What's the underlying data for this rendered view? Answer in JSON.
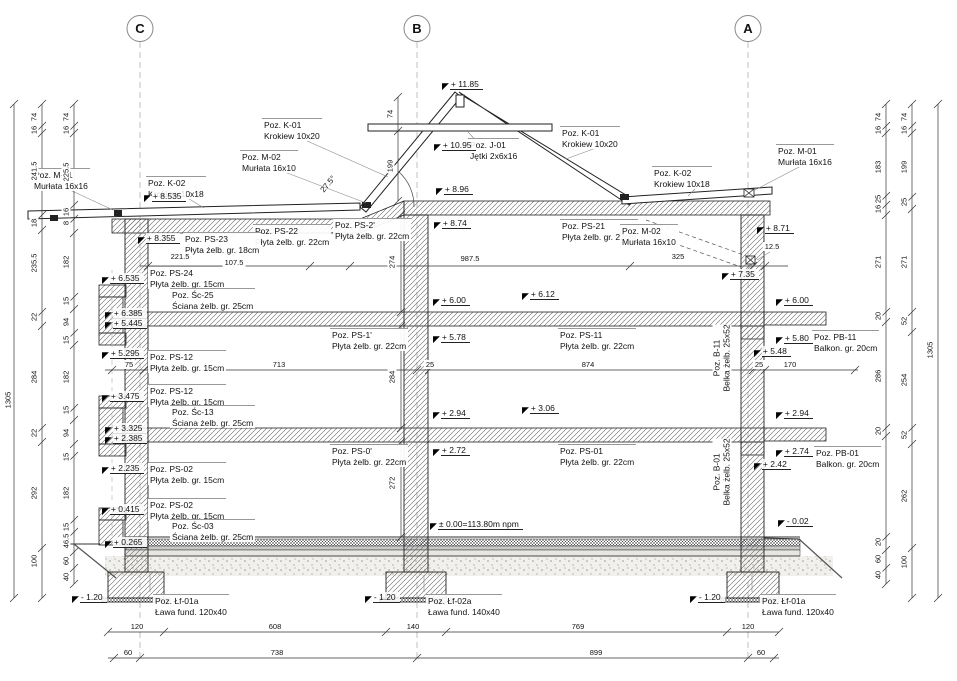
{
  "drawing": {
    "colors": {
      "line": "#222222",
      "dim_line": "#333333",
      "axis_dash": "#aaaaaa",
      "hatch": "#666666"
    },
    "axis_markers": [
      {
        "label": "C",
        "x": 140
      },
      {
        "label": "B",
        "x": 417
      },
      {
        "label": "A",
        "x": 748
      }
    ],
    "position_labels": [
      {
        "t": [
          "Poz. K-01",
          "Krokiew 10x20"
        ],
        "x": 262,
        "y": 118
      },
      {
        "t": [
          "Poz. M-02",
          "Murłata 16x10"
        ],
        "x": 240,
        "y": 150
      },
      {
        "t": [
          "Poz. J-01",
          "Jętki 2x6x16"
        ],
        "x": 468,
        "y": 138
      },
      {
        "t": [
          "Poz. K-01",
          "Krokiew 10x20"
        ],
        "x": 560,
        "y": 126
      },
      {
        "t": [
          "Poz. K-02",
          "Krokiew 10x18"
        ],
        "x": 652,
        "y": 166
      },
      {
        "t": [
          "Poz. M-01",
          "Murłata 16x16"
        ],
        "x": 776,
        "y": 144
      },
      {
        "t": [
          "Poz. M-01",
          "Murłata 16x16"
        ],
        "x": 32,
        "y": 168
      },
      {
        "t": [
          "Poz. K-02",
          "Krokiew 10x18"
        ],
        "x": 146,
        "y": 176
      },
      {
        "t": [
          "Poz. PS-22",
          "Płyta żelb. gr. 22cm"
        ],
        "x": 253,
        "y": 224
      },
      {
        "t": [
          "Poz. PS-2'",
          "Płyta żelb. gr. 22cm"
        ],
        "x": 333,
        "y": 218
      },
      {
        "t": [
          "Poz. PS-21",
          "Płyta żelb. gr. 22cm"
        ],
        "x": 560,
        "y": 219
      },
      {
        "t": [
          "Poz. M-02",
          "Murłata 16x10"
        ],
        "x": 620,
        "y": 224
      },
      {
        "t": [
          "Poz. PS-23",
          "Płyta żelb. gr. 18cm"
        ],
        "x": 183,
        "y": 232
      },
      {
        "t": [
          "Poz. PS-24",
          "Płyta żelb. gr. 15cm"
        ],
        "x": 148,
        "y": 266
      },
      {
        "t": [
          "Poz. Śc-25",
          "Ściana żelb. gr. 25cm"
        ],
        "x": 170,
        "y": 288
      },
      {
        "t": [
          "Poz. PS-1'",
          "Płyta żelb. gr. 22cm"
        ],
        "x": 330,
        "y": 328
      },
      {
        "t": [
          "Poz. PS-11",
          "Płyta żelb. gr. 22cm"
        ],
        "x": 558,
        "y": 328
      },
      {
        "t": [
          "Poz. PB-11",
          "Balkon. gr. 20cm"
        ],
        "x": 812,
        "y": 330
      },
      {
        "t": [
          "Poz. PS-12",
          "Płyta żelb. gr. 15cm"
        ],
        "x": 148,
        "y": 350
      },
      {
        "t": [
          "Poz. PS-12",
          "Płyta żelb. gr. 15cm"
        ],
        "x": 148,
        "y": 384
      },
      {
        "t": [
          "Poz. Śc-13",
          "Ściana żelb. gr. 25cm"
        ],
        "x": 170,
        "y": 405
      },
      {
        "t": [
          "Poz. PS-0'",
          "Płyta żelb. gr. 22cm"
        ],
        "x": 330,
        "y": 444
      },
      {
        "t": [
          "Poz. PS-01",
          "Płyta żelb. gr. 22cm"
        ],
        "x": 558,
        "y": 444
      },
      {
        "t": [
          "Poz. PB-01",
          "Balkon. gr. 20cm"
        ],
        "x": 814,
        "y": 446
      },
      {
        "t": [
          "Poz. PS-02",
          "Płyta żelb. gr. 15cm"
        ],
        "x": 148,
        "y": 462
      },
      {
        "t": [
          "Poz. PS-02",
          "Płyta żelb. gr. 15cm"
        ],
        "x": 148,
        "y": 498
      },
      {
        "t": [
          "Poz. Śc-03",
          "Ściana żelb. gr. 25cm"
        ],
        "x": 170,
        "y": 519
      },
      {
        "t": [
          "Poz. Łf-01a",
          "Ława fund. 120x40"
        ],
        "x": 153,
        "y": 594
      },
      {
        "t": [
          "Poz. Łf-02a",
          "Ława fund. 140x40"
        ],
        "x": 426,
        "y": 594
      },
      {
        "t": [
          "Poz. Łf-01a",
          "Ława fund. 120x40"
        ],
        "x": 760,
        "y": 594
      }
    ],
    "beam_labels": [
      {
        "t": [
          "Poz. B-11",
          "Belka żelb. 25x52"
        ],
        "x": 722,
        "y": 358
      },
      {
        "t": [
          "Poz. B-01",
          "Belka żelb. 25x52"
        ],
        "x": 722,
        "y": 472
      }
    ],
    "elevation_marks": [
      {
        "v": "+ 11.85",
        "x": 442,
        "y": 79
      },
      {
        "v": "+ 10.95",
        "x": 434,
        "y": 140
      },
      {
        "v": "+ 8.96",
        "x": 436,
        "y": 184
      },
      {
        "v": "+ 8.74",
        "x": 434,
        "y": 218
      },
      {
        "v": "+ 8.535",
        "x": 144,
        "y": 191
      },
      {
        "v": "+ 8.355",
        "x": 138,
        "y": 233
      },
      {
        "v": "+ 8.71",
        "x": 757,
        "y": 223
      },
      {
        "v": "+ 7.35",
        "x": 722,
        "y": 269
      },
      {
        "v": "+ 6.535",
        "x": 102,
        "y": 273
      },
      {
        "v": "+ 6.385",
        "x": 105,
        "y": 308
      },
      {
        "v": "+ 5.445",
        "x": 105,
        "y": 318
      },
      {
        "v": "+ 5.295",
        "x": 102,
        "y": 348
      },
      {
        "v": "+ 6.00",
        "x": 433,
        "y": 295
      },
      {
        "v": "+ 6.12",
        "x": 522,
        "y": 289
      },
      {
        "v": "+ 5.78",
        "x": 433,
        "y": 332
      },
      {
        "v": "+ 6.00",
        "x": 776,
        "y": 295
      },
      {
        "v": "+ 5.80",
        "x": 776,
        "y": 333
      },
      {
        "v": "+ 5.48",
        "x": 754,
        "y": 346
      },
      {
        "v": "+ 3.475",
        "x": 102,
        "y": 391
      },
      {
        "v": "+ 3.325",
        "x": 105,
        "y": 423
      },
      {
        "v": "+ 2.385",
        "x": 105,
        "y": 433
      },
      {
        "v": "+ 2.235",
        "x": 102,
        "y": 463
      },
      {
        "v": "+ 2.94",
        "x": 433,
        "y": 408
      },
      {
        "v": "+ 3.06",
        "x": 522,
        "y": 403
      },
      {
        "v": "+ 2.72",
        "x": 433,
        "y": 445
      },
      {
        "v": "+ 2.94",
        "x": 776,
        "y": 408
      },
      {
        "v": "+ 2.74",
        "x": 776,
        "y": 446
      },
      {
        "v": "+ 2.42",
        "x": 754,
        "y": 459
      },
      {
        "v": "+ 0.415",
        "x": 102,
        "y": 504
      },
      {
        "v": "+ 0.265",
        "x": 105,
        "y": 537
      },
      {
        "v": "± 0.00=113.80m npm",
        "x": 430,
        "y": 519
      },
      {
        "v": "- 0.02",
        "x": 778,
        "y": 516
      },
      {
        "v": "- 1.20",
        "x": 72,
        "y": 592
      },
      {
        "v": "- 1.20",
        "x": 365,
        "y": 592
      },
      {
        "v": "- 1.20",
        "x": 690,
        "y": 592
      }
    ],
    "dim_vertical": [
      {
        "v": "74",
        "x": 66,
        "y": 117
      },
      {
        "v": "16",
        "x": 66,
        "y": 130
      },
      {
        "v": "225.5",
        "x": 66,
        "y": 172
      },
      {
        "v": "16",
        "x": 66,
        "y": 212
      },
      {
        "v": "8",
        "x": 66,
        "y": 223
      },
      {
        "v": "182",
        "x": 66,
        "y": 262
      },
      {
        "v": "15",
        "x": 66,
        "y": 301
      },
      {
        "v": "94",
        "x": 66,
        "y": 322
      },
      {
        "v": "15",
        "x": 66,
        "y": 340
      },
      {
        "v": "182",
        "x": 66,
        "y": 377
      },
      {
        "v": "15",
        "x": 66,
        "y": 410
      },
      {
        "v": "94",
        "x": 66,
        "y": 433
      },
      {
        "v": "15",
        "x": 66,
        "y": 457
      },
      {
        "v": "182",
        "x": 66,
        "y": 493
      },
      {
        "v": "15",
        "x": 66,
        "y": 527
      },
      {
        "v": "46.5",
        "x": 66,
        "y": 541
      },
      {
        "v": "60",
        "x": 66,
        "y": 561
      },
      {
        "v": "40",
        "x": 66,
        "y": 577
      },
      {
        "v": "74",
        "x": 34,
        "y": 117
      },
      {
        "v": "16",
        "x": 34,
        "y": 130
      },
      {
        "v": "241.5",
        "x": 34,
        "y": 171
      },
      {
        "v": "18",
        "x": 34,
        "y": 223
      },
      {
        "v": "235.5",
        "x": 34,
        "y": 263
      },
      {
        "v": "22",
        "x": 34,
        "y": 317
      },
      {
        "v": "284",
        "x": 34,
        "y": 377
      },
      {
        "v": "22",
        "x": 34,
        "y": 433
      },
      {
        "v": "292",
        "x": 34,
        "y": 493
      },
      {
        "v": "100",
        "x": 34,
        "y": 561
      },
      {
        "v": "1305",
        "x": 8,
        "y": 400
      },
      {
        "v": "74",
        "x": 390,
        "y": 114
      },
      {
        "v": "199",
        "x": 390,
        "y": 166
      },
      {
        "v": "274",
        "x": 392,
        "y": 262
      },
      {
        "v": "284",
        "x": 392,
        "y": 377
      },
      {
        "v": "272",
        "x": 392,
        "y": 483
      },
      {
        "v": "74",
        "x": 878,
        "y": 117
      },
      {
        "v": "16",
        "x": 878,
        "y": 130
      },
      {
        "v": "183",
        "x": 878,
        "y": 167
      },
      {
        "v": "25",
        "x": 878,
        "y": 199
      },
      {
        "v": "16",
        "x": 878,
        "y": 209
      },
      {
        "v": "271",
        "x": 878,
        "y": 262
      },
      {
        "v": "20",
        "x": 878,
        "y": 316
      },
      {
        "v": "286",
        "x": 878,
        "y": 376
      },
      {
        "v": "20",
        "x": 878,
        "y": 431
      },
      {
        "v": "20",
        "x": 878,
        "y": 542
      },
      {
        "v": "60",
        "x": 878,
        "y": 559
      },
      {
        "v": "40",
        "x": 878,
        "y": 575
      },
      {
        "v": "74",
        "x": 904,
        "y": 117
      },
      {
        "v": "16",
        "x": 904,
        "y": 130
      },
      {
        "v": "199",
        "x": 904,
        "y": 167
      },
      {
        "v": "25",
        "x": 904,
        "y": 202
      },
      {
        "v": "271",
        "x": 904,
        "y": 262
      },
      {
        "v": "52",
        "x": 904,
        "y": 321
      },
      {
        "v": "254",
        "x": 904,
        "y": 380
      },
      {
        "v": "52",
        "x": 904,
        "y": 435
      },
      {
        "v": "262",
        "x": 904,
        "y": 496
      },
      {
        "v": "100",
        "x": 904,
        "y": 562
      },
      {
        "v": "1305",
        "x": 930,
        "y": 350
      }
    ],
    "dim_horizontal": [
      {
        "v": "221.5",
        "x": 180,
        "y": 252
      },
      {
        "v": "107.5",
        "x": 234,
        "y": 258
      },
      {
        "v": "987.5",
        "x": 470,
        "y": 254
      },
      {
        "v": "325",
        "x": 678,
        "y": 252
      },
      {
        "v": "12.5",
        "x": 772,
        "y": 242
      },
      {
        "v": "75",
        "x": 129,
        "y": 360
      },
      {
        "v": "713",
        "x": 279,
        "y": 360
      },
      {
        "v": "25",
        "x": 430,
        "y": 360
      },
      {
        "v": "874",
        "x": 588,
        "y": 360
      },
      {
        "v": "25",
        "x": 759,
        "y": 360
      },
      {
        "v": "170",
        "x": 790,
        "y": 360
      },
      {
        "v": "120",
        "x": 137,
        "y": 622
      },
      {
        "v": "608",
        "x": 275,
        "y": 622
      },
      {
        "v": "140",
        "x": 413,
        "y": 622
      },
      {
        "v": "769",
        "x": 578,
        "y": 622
      },
      {
        "v": "120",
        "x": 748,
        "y": 622
      },
      {
        "v": "60",
        "x": 128,
        "y": 648
      },
      {
        "v": "738",
        "x": 277,
        "y": 648
      },
      {
        "v": "899",
        "x": 596,
        "y": 648
      },
      {
        "v": "60",
        "x": 761,
        "y": 648
      }
    ],
    "angle_label": {
      "v": "27.5°",
      "x": 328,
      "y": 184
    },
    "elevation_triangle_glyph": "◤"
  }
}
